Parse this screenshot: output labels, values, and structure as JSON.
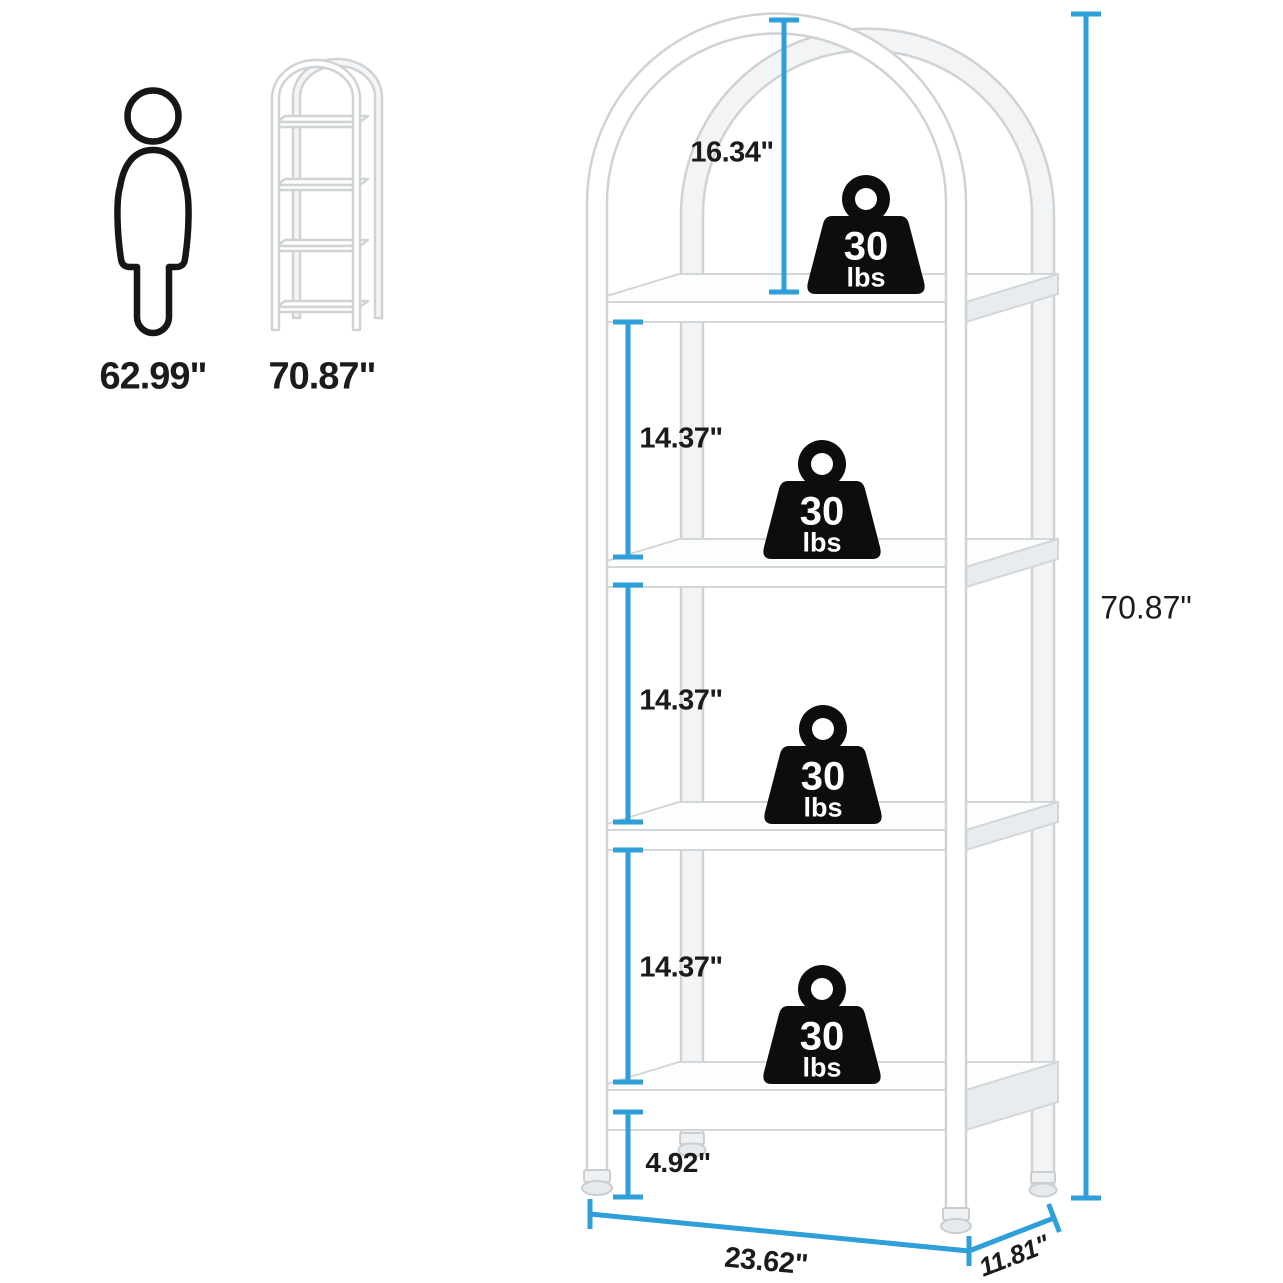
{
  "palette": {
    "dimension_line": "#2e9fd8",
    "label_ink": "#1b1b1b",
    "weight_icon_fill": "#0d0d0d",
    "frame_stroke": "#d3d7da"
  },
  "size_reference": {
    "person_height": "62.99\"",
    "bookshelf_height": "70.87\""
  },
  "dimensions": {
    "arch_to_first_shelf": "16.34\"",
    "shelf_gap_1": "14.37\"",
    "shelf_gap_2": "14.37\"",
    "shelf_gap_3": "14.37\"",
    "bottom_clearance": "4.92\"",
    "overall_height": "70.87\"",
    "width": "23.62\"",
    "depth": "11.81\""
  },
  "shelf_load": {
    "tiers": [
      {
        "value": "30",
        "unit": "lbs"
      },
      {
        "value": "30",
        "unit": "lbs"
      },
      {
        "value": "30",
        "unit": "lbs"
      },
      {
        "value": "30",
        "unit": "lbs"
      }
    ]
  }
}
